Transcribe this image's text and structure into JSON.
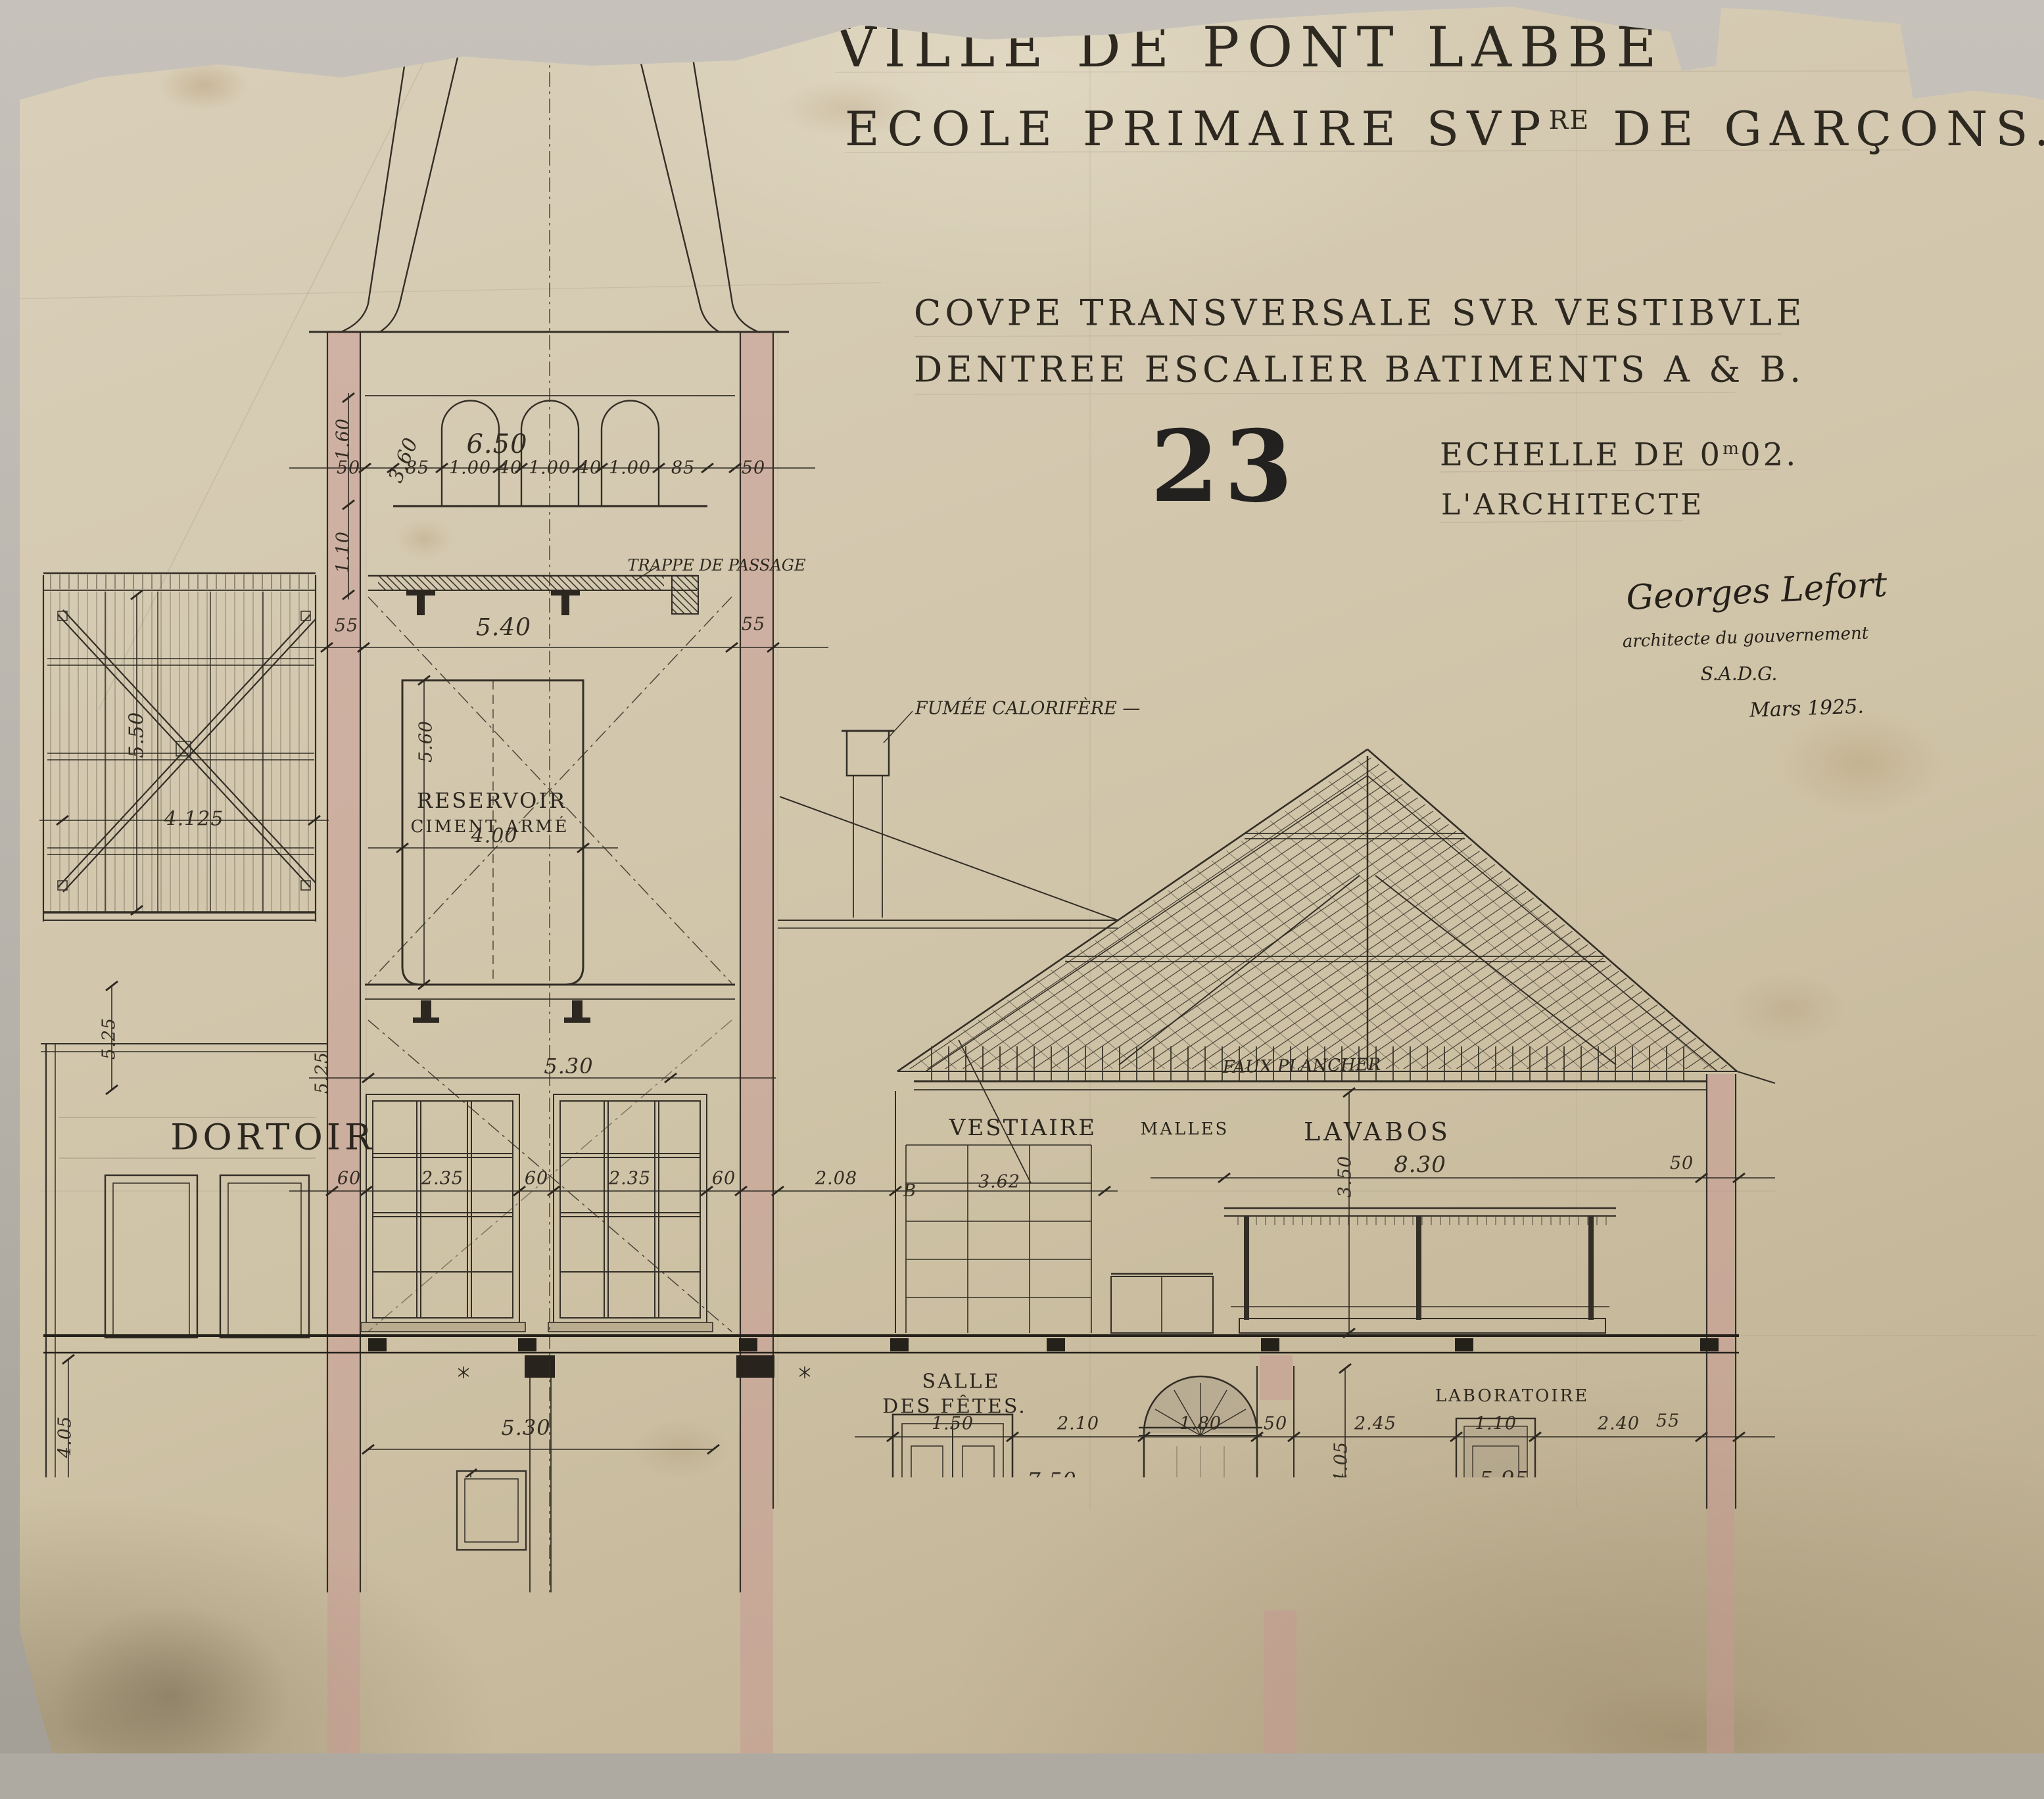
{
  "paper": {
    "ink": "#312b22",
    "pink": "#c79793",
    "bg": "#d2c7ae"
  },
  "title": {
    "line1": "VILLE DE PONT LABBE",
    "line2_pre": "ECOLE PRIMAIRE SVP",
    "line2_sup": "RE",
    "line2_post": " DE GARÇONS."
  },
  "subtitle": {
    "line1": "COVPE TRANSVERSALE SVR VESTIBVLE",
    "line2": "DENTREE ESCALIER BATIMENTS A & B."
  },
  "sheet": {
    "number": "23",
    "scale_pre": "ECHELLE DE 0",
    "scale_sup": "m",
    "scale_post": "02.",
    "architect_label": "L'ARCHITECTE",
    "signature": "Georges Lefort",
    "sig_role": "architecte du gouvernement",
    "sig_org": "S.A.D.G.",
    "sig_date": "Mars 1925."
  },
  "rooms": {
    "dortoir": "DORTOIR",
    "vestiaire": "VESTIAIRE",
    "malles": "MALLES",
    "lavabos": "LAVABOS",
    "salle1": "SALLE",
    "salle2": "DES FÊTES.",
    "laboratoire": "LABORATOIRE",
    "reservoir1": "RESERVOIR",
    "reservoir2": "CIMENT ARMÉ",
    "cour_word": "COVR",
    "cour_de": "des",
    "cour_jeux": "JEVX."
  },
  "notes": {
    "trappe": "TRAPPE DE PASSAGE",
    "fumee": "FUMÉE CALORIFÈRE —",
    "faux_plancher": "FAUX PLANCHER",
    "calorifere": "CALORIFÈRE",
    "remblai": "REMBLAI",
    "axis_b": "B"
  },
  "dims": {
    "d160": "1.60",
    "d110": "1.10",
    "d360": "3.60",
    "d650": "6.50",
    "d50": "50",
    "d85": "85",
    "d100": "1.00",
    "d40": "40",
    "d540": "5.40",
    "d55": "55",
    "d550": "5.50",
    "d4125": "4.125",
    "d560": "5.60",
    "d400": "4.00",
    "d525": "5.25",
    "d530": "5.30",
    "d60": "60",
    "d235": "2.35",
    "d208": "2.08",
    "d362": "3.62",
    "d350": "3.50",
    "d830": "8.30",
    "d405": "4.05",
    "d25": "25",
    "d245": "2.45",
    "d290": "2.90",
    "d150": "1.50",
    "d210": "2.10",
    "d180": "1.80",
    "d750": "7.50",
    "d240": "2.40",
    "d595": "5.95",
    "d70": "70",
    "d515": "5.15",
    "d745": "7.45",
    "d280": "2.80",
    "d120": "1.20"
  }
}
